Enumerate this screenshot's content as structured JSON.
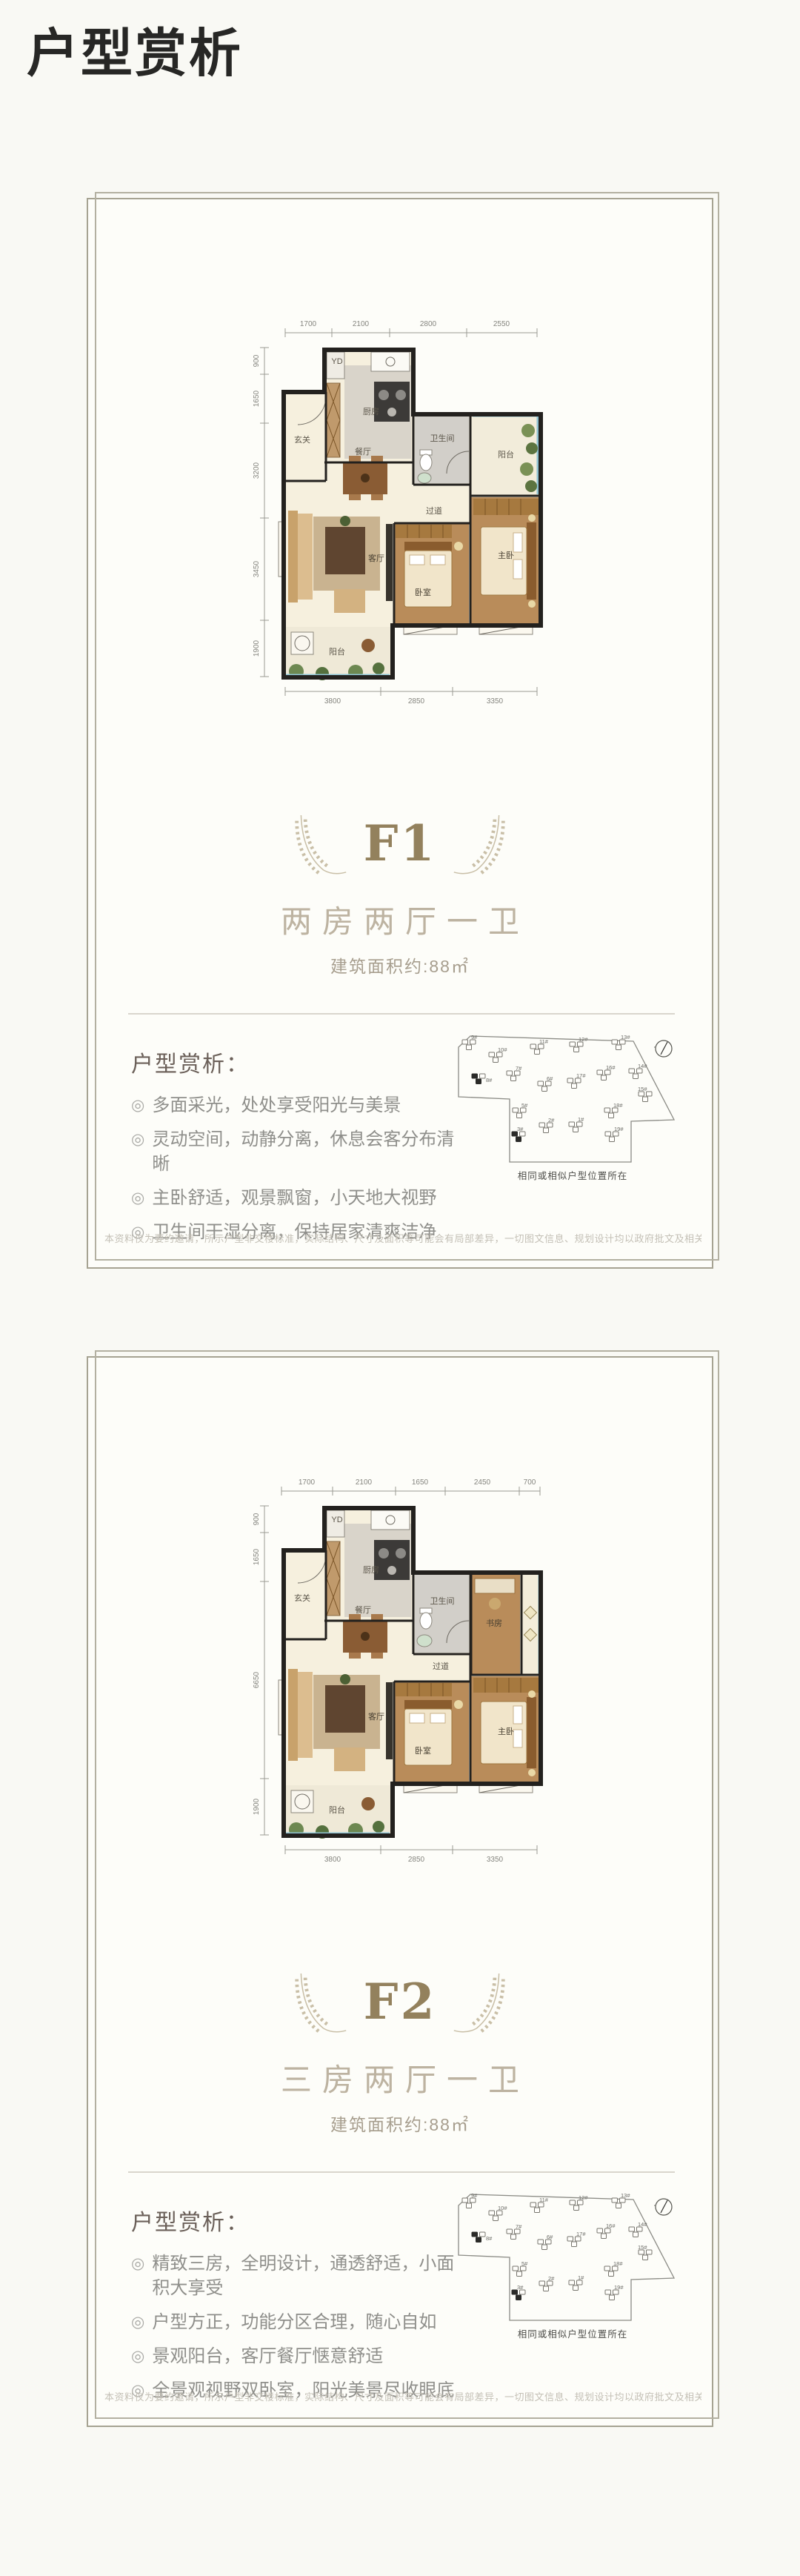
{
  "page": {
    "title": "户型赏析"
  },
  "siteplan": {
    "caption": "相同或相似户型位置所在",
    "buildings": [
      "9#",
      "10#",
      "11#",
      "12#",
      "13#",
      "7#",
      "8#",
      "6#",
      "17#",
      "16#",
      "14#",
      "15#",
      "5#",
      "2#",
      "1#",
      "18#",
      "3#",
      "19#"
    ]
  },
  "disclaimer": "本资料仅为要约邀请，所示户型非交楼标准，实际结构、尺寸及面积等可能会有局部差异，一切图文信息、规划设计均以政府批文及相关合同为准，最终解释权归开发商所有。",
  "cards": [
    {
      "unit": "F1",
      "layout_name": "两房两厅一卫",
      "area_label": "建筑面积约:88㎡",
      "analysis_heading": "户型赏析：",
      "bullets": [
        "多面采光，处处享受阳光与美景",
        "灵动空间，动静分离，休息会客分布清晰",
        "主卧舒适，观景飘窗，小天地大视野",
        "卫生间干湿分离，保持居家清爽洁净"
      ],
      "floorplan": {
        "rooms": {
          "entry": "玄关",
          "kitchen": "厨房",
          "laundry": "YD",
          "dining": "餐厅",
          "bath": "卫生间",
          "corridor": "过道",
          "balcony_right": "阳台",
          "living": "客厅",
          "bedroom": "卧室",
          "master": "主卧",
          "balcony_bottom": "阳台"
        },
        "dims_top": [
          "1700",
          "2100",
          "2800",
          "2550"
        ],
        "dims_left": [
          "900",
          "1650",
          "3200",
          "3450",
          "1900"
        ],
        "dims_bottom": [
          "3800",
          "2850",
          "3350"
        ]
      }
    },
    {
      "unit": "F2",
      "layout_name": "三房两厅一卫",
      "area_label": "建筑面积约:88㎡",
      "analysis_heading": "户型赏析：",
      "bullets": [
        "精致三房，全明设计，通透舒适，小面积大享受",
        "户型方正，功能分区合理，随心自如",
        "景观阳台，客厅餐厅惬意舒适",
        "全景观视野双卧室，阳光美景尽收眼底"
      ],
      "floorplan": {
        "rooms": {
          "entry": "玄关",
          "kitchen": "厨房",
          "laundry": "YD",
          "dining": "餐厅",
          "bath": "卫生间",
          "corridor": "过道",
          "study": "书房",
          "living": "客厅",
          "bedroom": "卧室",
          "master": "主卧",
          "balcony_bottom": "阳台"
        },
        "dims_top": [
          "1700",
          "2100",
          "1650",
          "2450",
          "700"
        ],
        "dims_left": [
          "900",
          "1650",
          "6650",
          "1900"
        ],
        "dims_bottom": [
          "3800",
          "2850",
          "3350"
        ]
      }
    }
  ]
}
